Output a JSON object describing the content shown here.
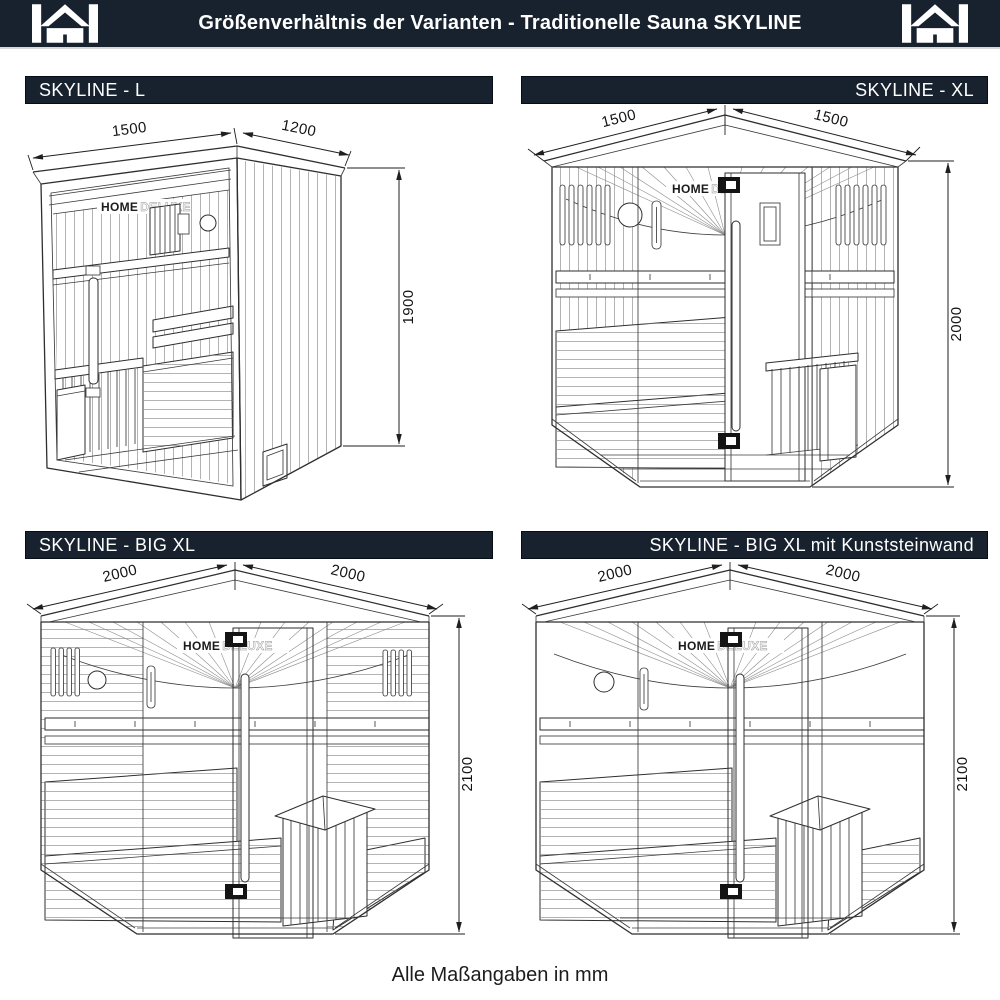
{
  "page": {
    "header": {
      "title": "Größenverhältnis der Varianten - Traditionelle Sauna SKYLINE"
    },
    "footer": {
      "note": "Alle Maßangaben in mm"
    },
    "brand": {
      "logo_home": "HOME",
      "logo_deluxe": "DELUXE"
    }
  },
  "colors": {
    "header_bg": "#17222e",
    "header_text": "#ffffff",
    "line_art": "#2e2e2e",
    "dimension_text": "#141414",
    "background": "#ffffff"
  },
  "variants": [
    {
      "id": "l",
      "label": "SKYLINE - L",
      "width_mm": "1500",
      "depth_mm": "1200",
      "height_mm": "1900"
    },
    {
      "id": "xl",
      "label": "SKYLINE - XL",
      "width_mm": "1500",
      "depth_mm": "1500",
      "height_mm": "2000"
    },
    {
      "id": "bigxl",
      "label": "SKYLINE - BIG XL",
      "width_mm": "2000",
      "depth_mm": "2000",
      "height_mm": "2100"
    },
    {
      "id": "bigxl_stone",
      "label": "SKYLINE - BIG XL mit Kunststeinwand",
      "width_mm": "2000",
      "depth_mm": "2000",
      "height_mm": "2100"
    }
  ]
}
